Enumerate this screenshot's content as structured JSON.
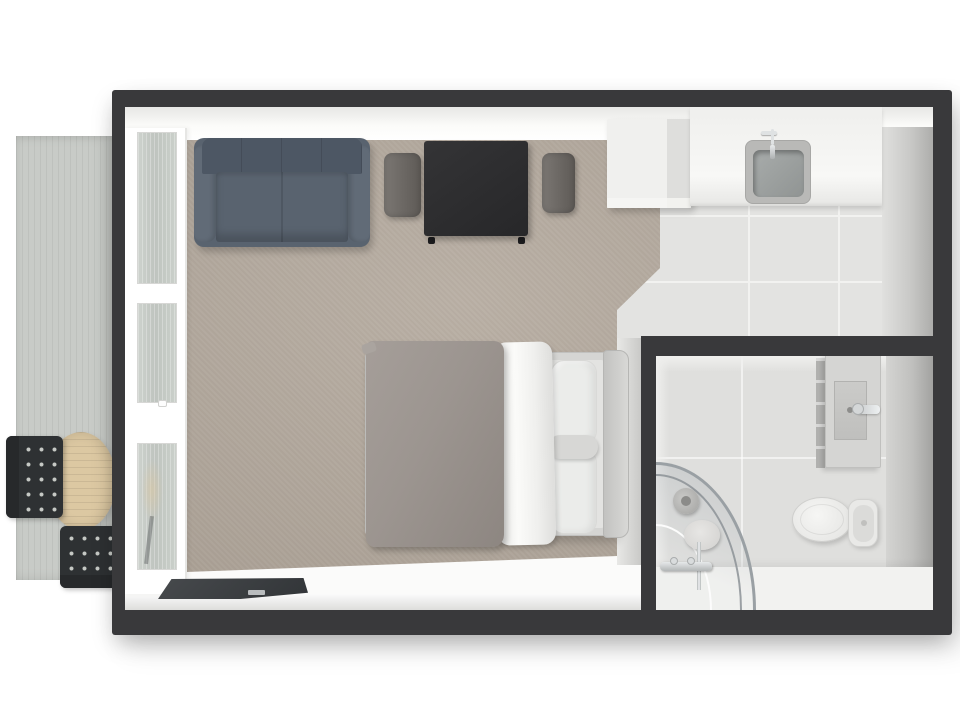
{
  "scene": {
    "title": "3D top-down floor plan of a studio apartment with balcony",
    "page_bg": "#ffffff"
  },
  "palette": {
    "page_bg": "#ffffff",
    "wall": "#39393b",
    "floor": "#fbfbfa",
    "carpet": "#b2a79b",
    "tile": "#e3e3e1",
    "grout": "#f2f2f0",
    "bath_tile": "#dfdfdd",
    "bath_floor": "#f2f2f0",
    "deck": "#c8cbc7",
    "frame": "#ffffff",
    "glass": "#c5cac5",
    "sofa_back": "#4d5764",
    "sofa_arm": "#616b77",
    "sofa_seat": "#59636f",
    "table_dark": "#2d2d2f",
    "chair_gray": "#6f6b67",
    "cabinet": "#eeeeec",
    "counter": "#f3f3f1",
    "sink_steel": "#9ea2a1",
    "chrome": "#dfe2e3",
    "bed_frame": "#d5d5d3",
    "headboard": "#cbcbc9",
    "duvet": "#9c9590",
    "sheet": "#f4f4f2",
    "pillow": "#ebecea",
    "bolster": "#d7d7d5",
    "mat": "#3a3d40",
    "mat_label": "#b9bcbe",
    "outdoor_table": "#dcc8a2",
    "outdoor_chair": "#2e3133",
    "outdoor_chair_dot": "#c6c9c5",
    "porcelain": "#f1f1ef",
    "tank": "#e9e9e7",
    "vanity": "#d5d5d3"
  },
  "labels": {
    "plan": "studio apartment 3D floor plan",
    "balcony": "balcony with wood decking",
    "outdoor_table": "round outdoor table",
    "outdoor_chair_left": "outdoor metal chair (left)",
    "outdoor_chair_bottom": "outdoor metal chair (bottom)",
    "windows": "floor-to-ceiling window wall",
    "living_area": "carpeted living and sleeping area",
    "sofa": "two-seat sofa",
    "dining_table": "dark dining table",
    "dining_chair_left": "upholstered dining chair (left)",
    "dining_chair_right": "upholstered dining chair (right)",
    "wardrobe": "white wardrobe cabinet",
    "kitchen": "kitchenette with tiled floor",
    "counter": "kitchen counter",
    "sink": "kitchen sink",
    "bed": "double bed with gray duvet and pillows",
    "doormat": "dark entry doormat",
    "bathroom": "bathroom",
    "shower": "corner shower with curved glass",
    "toilet": "toilet",
    "vanity": "wall-mounted vanity basin"
  }
}
